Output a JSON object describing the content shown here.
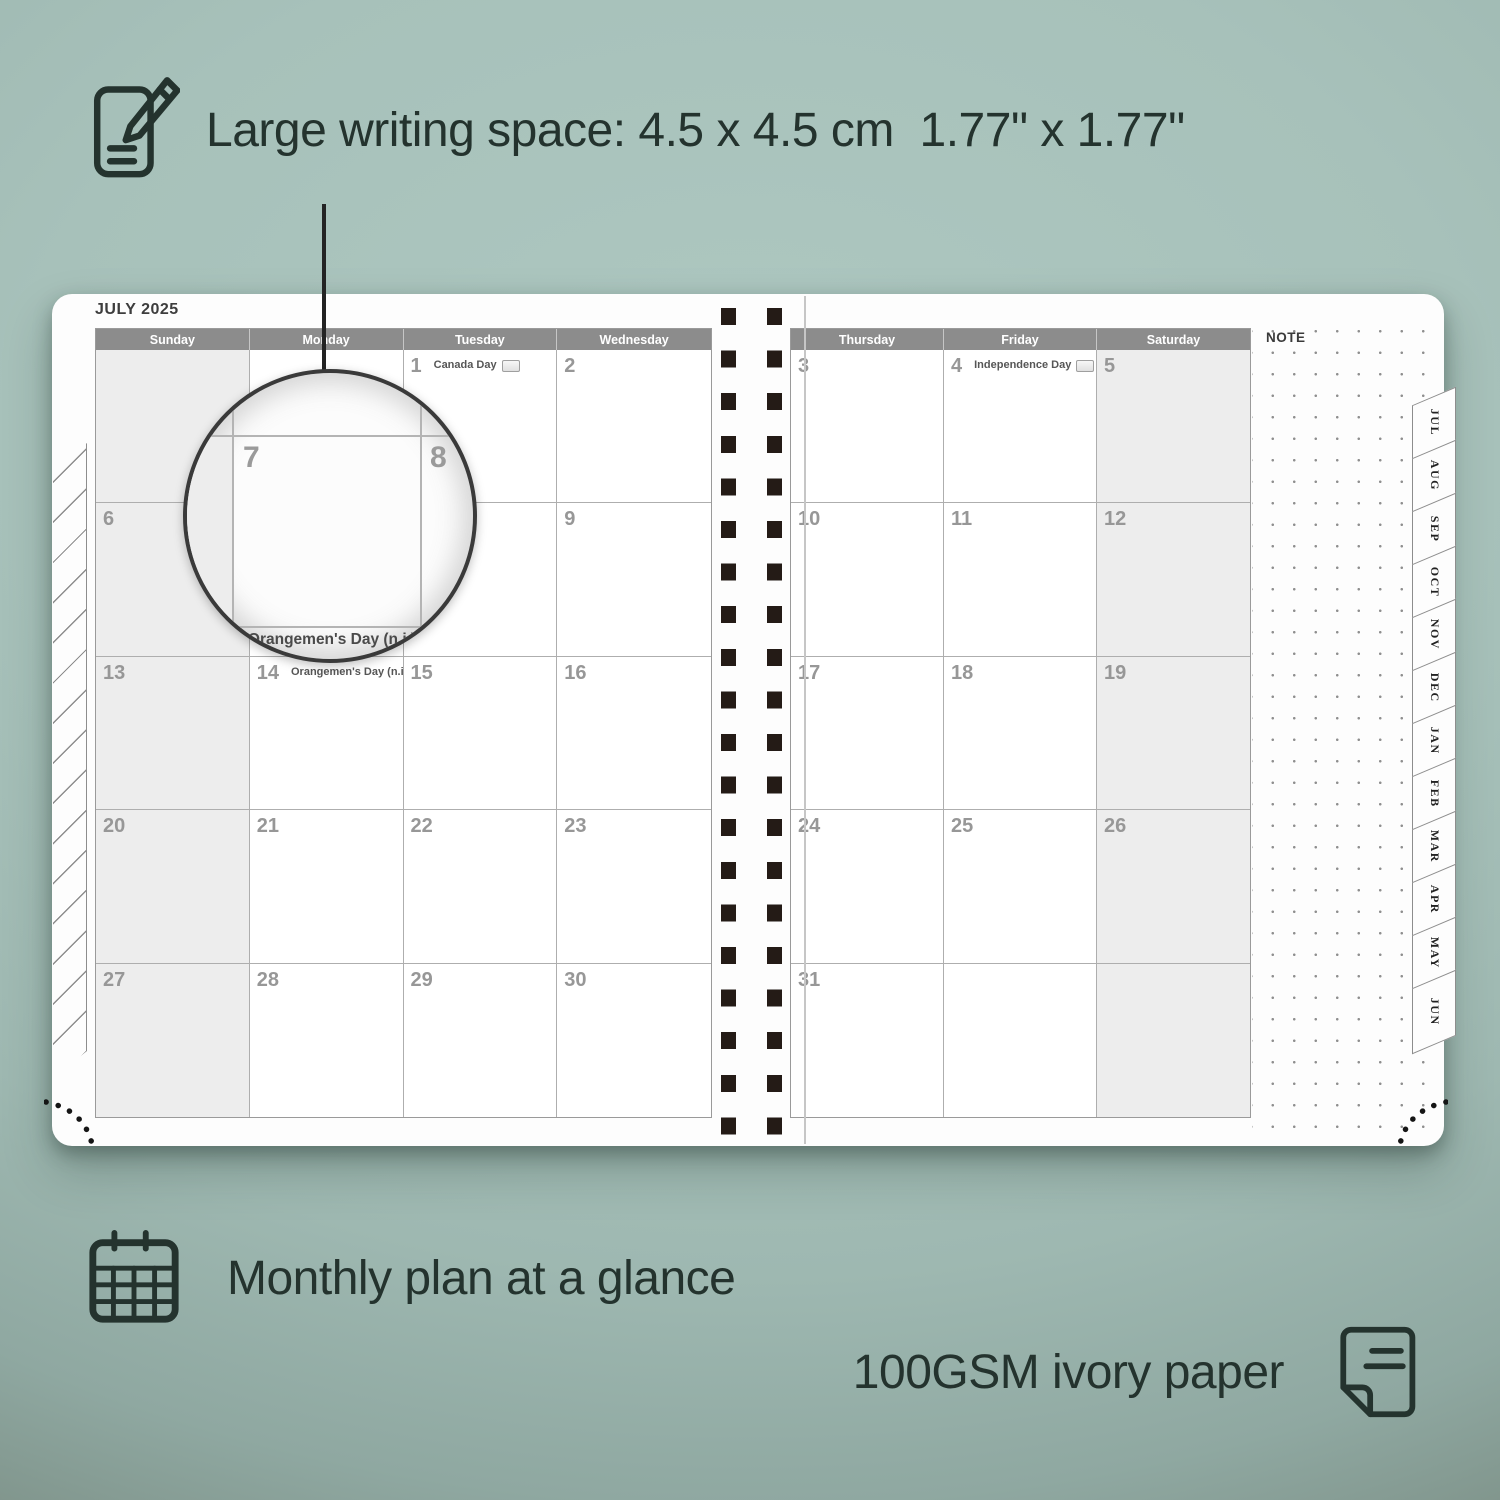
{
  "annotations": {
    "writing_space": {
      "text": "Large writing space: 4.5 x 4.5 cm  1.77\" x 1.77\"",
      "icon": "pencil-note-icon"
    },
    "monthly": {
      "text": "Monthly plan at a glance",
      "icon": "calendar-grid-icon"
    },
    "paper": {
      "text": "100GSM ivory paper",
      "icon": "paper-sheet-icon"
    }
  },
  "planner": {
    "month_title": "JULY 2025",
    "note_label": "NOTE",
    "left_day_headers": [
      "Sunday",
      "Monday",
      "Tuesday",
      "Wednesday"
    ],
    "right_day_headers": [
      "Thursday",
      "Friday",
      "Saturday"
    ],
    "left_cells": [
      {
        "d": "",
        "h": ""
      },
      {
        "d": "",
        "h": ""
      },
      {
        "d": "1",
        "h": "Canada Day"
      },
      {
        "d": "2",
        "h": ""
      },
      {
        "d": "6",
        "h": ""
      },
      {
        "d": "7",
        "h": ""
      },
      {
        "d": "8",
        "h": ""
      },
      {
        "d": "9",
        "h": ""
      },
      {
        "d": "13",
        "h": ""
      },
      {
        "d": "14",
        "h": "Orangemen's Day (n.i.)"
      },
      {
        "d": "15",
        "h": ""
      },
      {
        "d": "16",
        "h": ""
      },
      {
        "d": "20",
        "h": ""
      },
      {
        "d": "21",
        "h": ""
      },
      {
        "d": "22",
        "h": ""
      },
      {
        "d": "23",
        "h": ""
      },
      {
        "d": "27",
        "h": ""
      },
      {
        "d": "28",
        "h": ""
      },
      {
        "d": "29",
        "h": ""
      },
      {
        "d": "30",
        "h": ""
      }
    ],
    "right_cells": [
      {
        "d": "3",
        "h": ""
      },
      {
        "d": "4",
        "h": "Independence Day"
      },
      {
        "d": "5",
        "h": ""
      },
      {
        "d": "10",
        "h": ""
      },
      {
        "d": "11",
        "h": ""
      },
      {
        "d": "12",
        "h": ""
      },
      {
        "d": "17",
        "h": ""
      },
      {
        "d": "18",
        "h": ""
      },
      {
        "d": "19",
        "h": ""
      },
      {
        "d": "24",
        "h": ""
      },
      {
        "d": "25",
        "h": ""
      },
      {
        "d": "26",
        "h": ""
      },
      {
        "d": "31",
        "h": ""
      },
      {
        "d": "",
        "h": ""
      },
      {
        "d": "",
        "h": ""
      }
    ],
    "month_tabs": [
      "JUL",
      "AUG",
      "SEP",
      "OCT",
      "NOV",
      "DEC",
      "JAN",
      "FEB",
      "MAR",
      "APR",
      "MAY",
      "JUN"
    ],
    "magnifier": {
      "left_day": "7",
      "right_day": "8",
      "caption": "Orangemen's Day (n.i.)"
    }
  },
  "colors": {
    "background_sage": "#a7c1ba",
    "header_gray": "#8c8c8c",
    "shaded_cell": "#ededed",
    "spiral_dark": "#241b16",
    "annotation_ink": "#24332e"
  }
}
